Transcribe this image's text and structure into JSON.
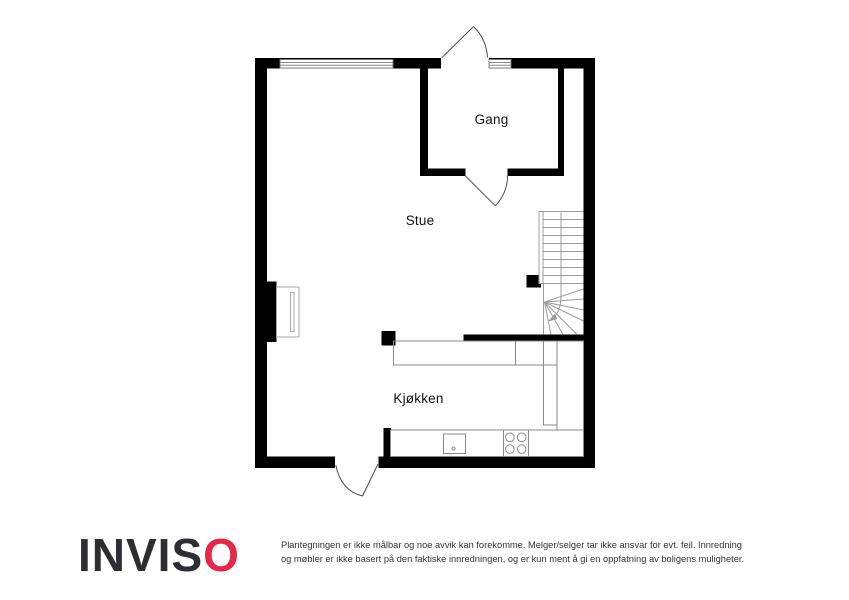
{
  "floorplan": {
    "rooms": [
      {
        "name": "Gang"
      },
      {
        "name": "Stue"
      },
      {
        "name": "Kjøkken"
      }
    ]
  },
  "branding": {
    "logo_primary": "INVIS",
    "logo_accent": "O",
    "logo_dark_color": "#2e2d33",
    "logo_red_color": "#e5284a"
  },
  "disclaimer": {
    "line1": "Plantegningen er ikke målbar og noe avvik kan forekomme. Melger/selger tar ikke ansvar for evt. feil. Innredning",
    "line2": "og møbler er ikke basert på den faktiske innredningen, og er kun ment å gi en oppfatning av boligens muligheter."
  },
  "colors": {
    "wall": "#000000",
    "fixture_line": "#8a8a8a",
    "stair_line": "#9c9c9c",
    "label_text": "#111111",
    "disclaimer_text": "#333333",
    "background": "#ffffff"
  }
}
